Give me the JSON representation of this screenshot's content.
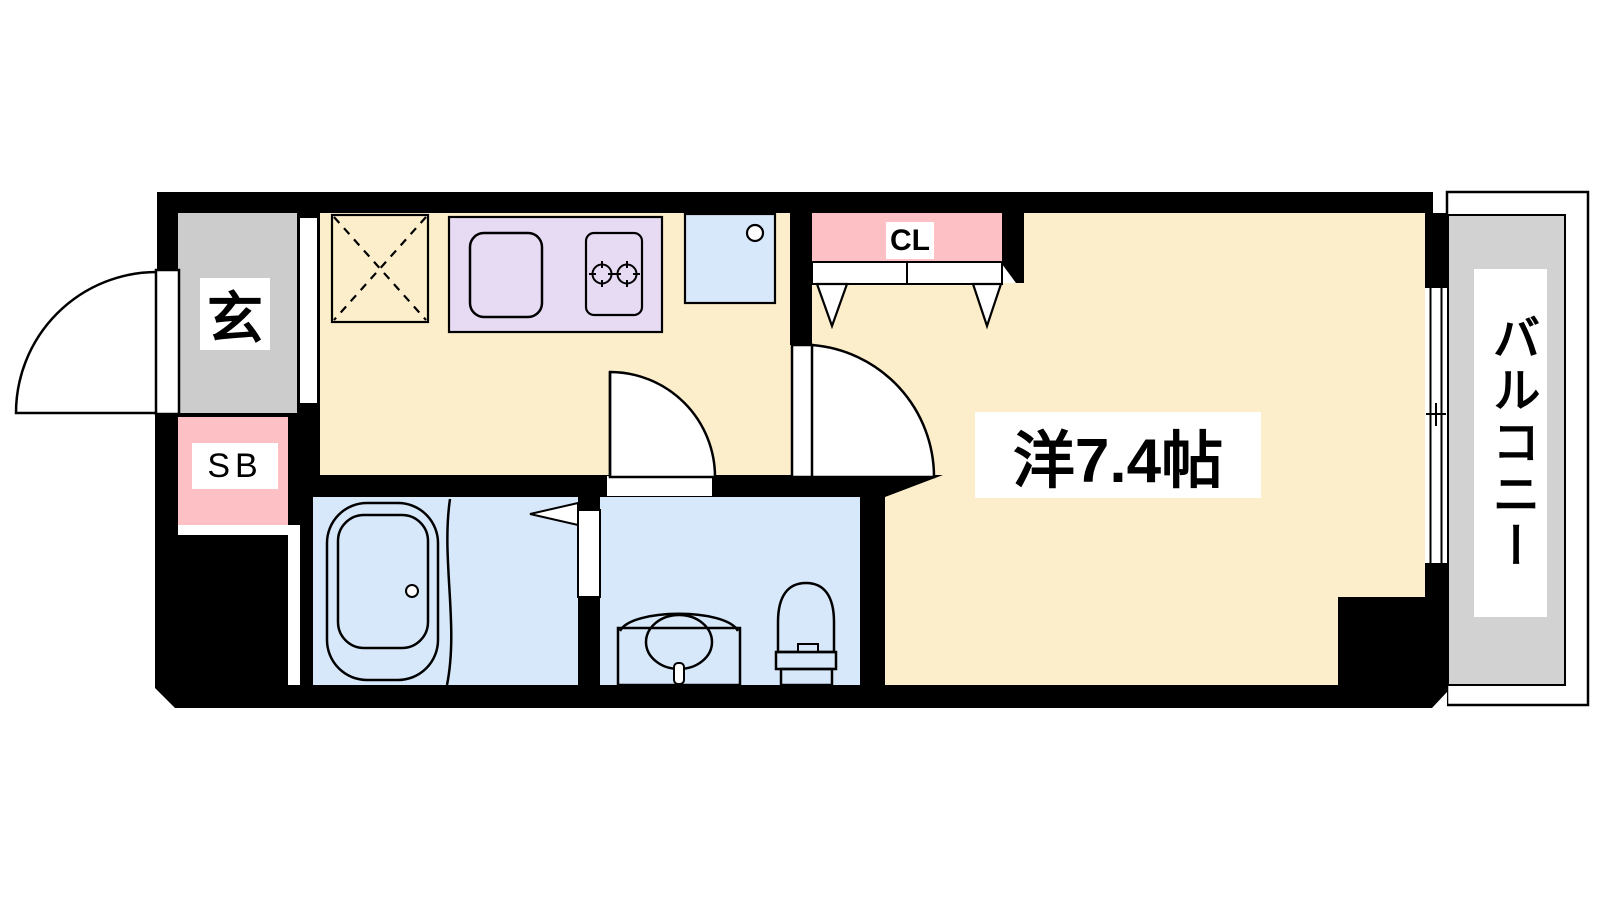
{
  "labels": {
    "genkan": "玄",
    "shoe_box": "SB",
    "closet": "CL",
    "main_room": "洋7.4帖",
    "balcony": "バルコニー"
  },
  "colors": {
    "wall": "#000000",
    "floor_cream": "#FCEECB",
    "entrance_gray": "#CCCCCC",
    "balcony_gray": "#D2D2D2",
    "pink": "#FCC0C5",
    "kitchen_purple": "#E7DBF4",
    "wet_blue": "#D8E8FB"
  }
}
